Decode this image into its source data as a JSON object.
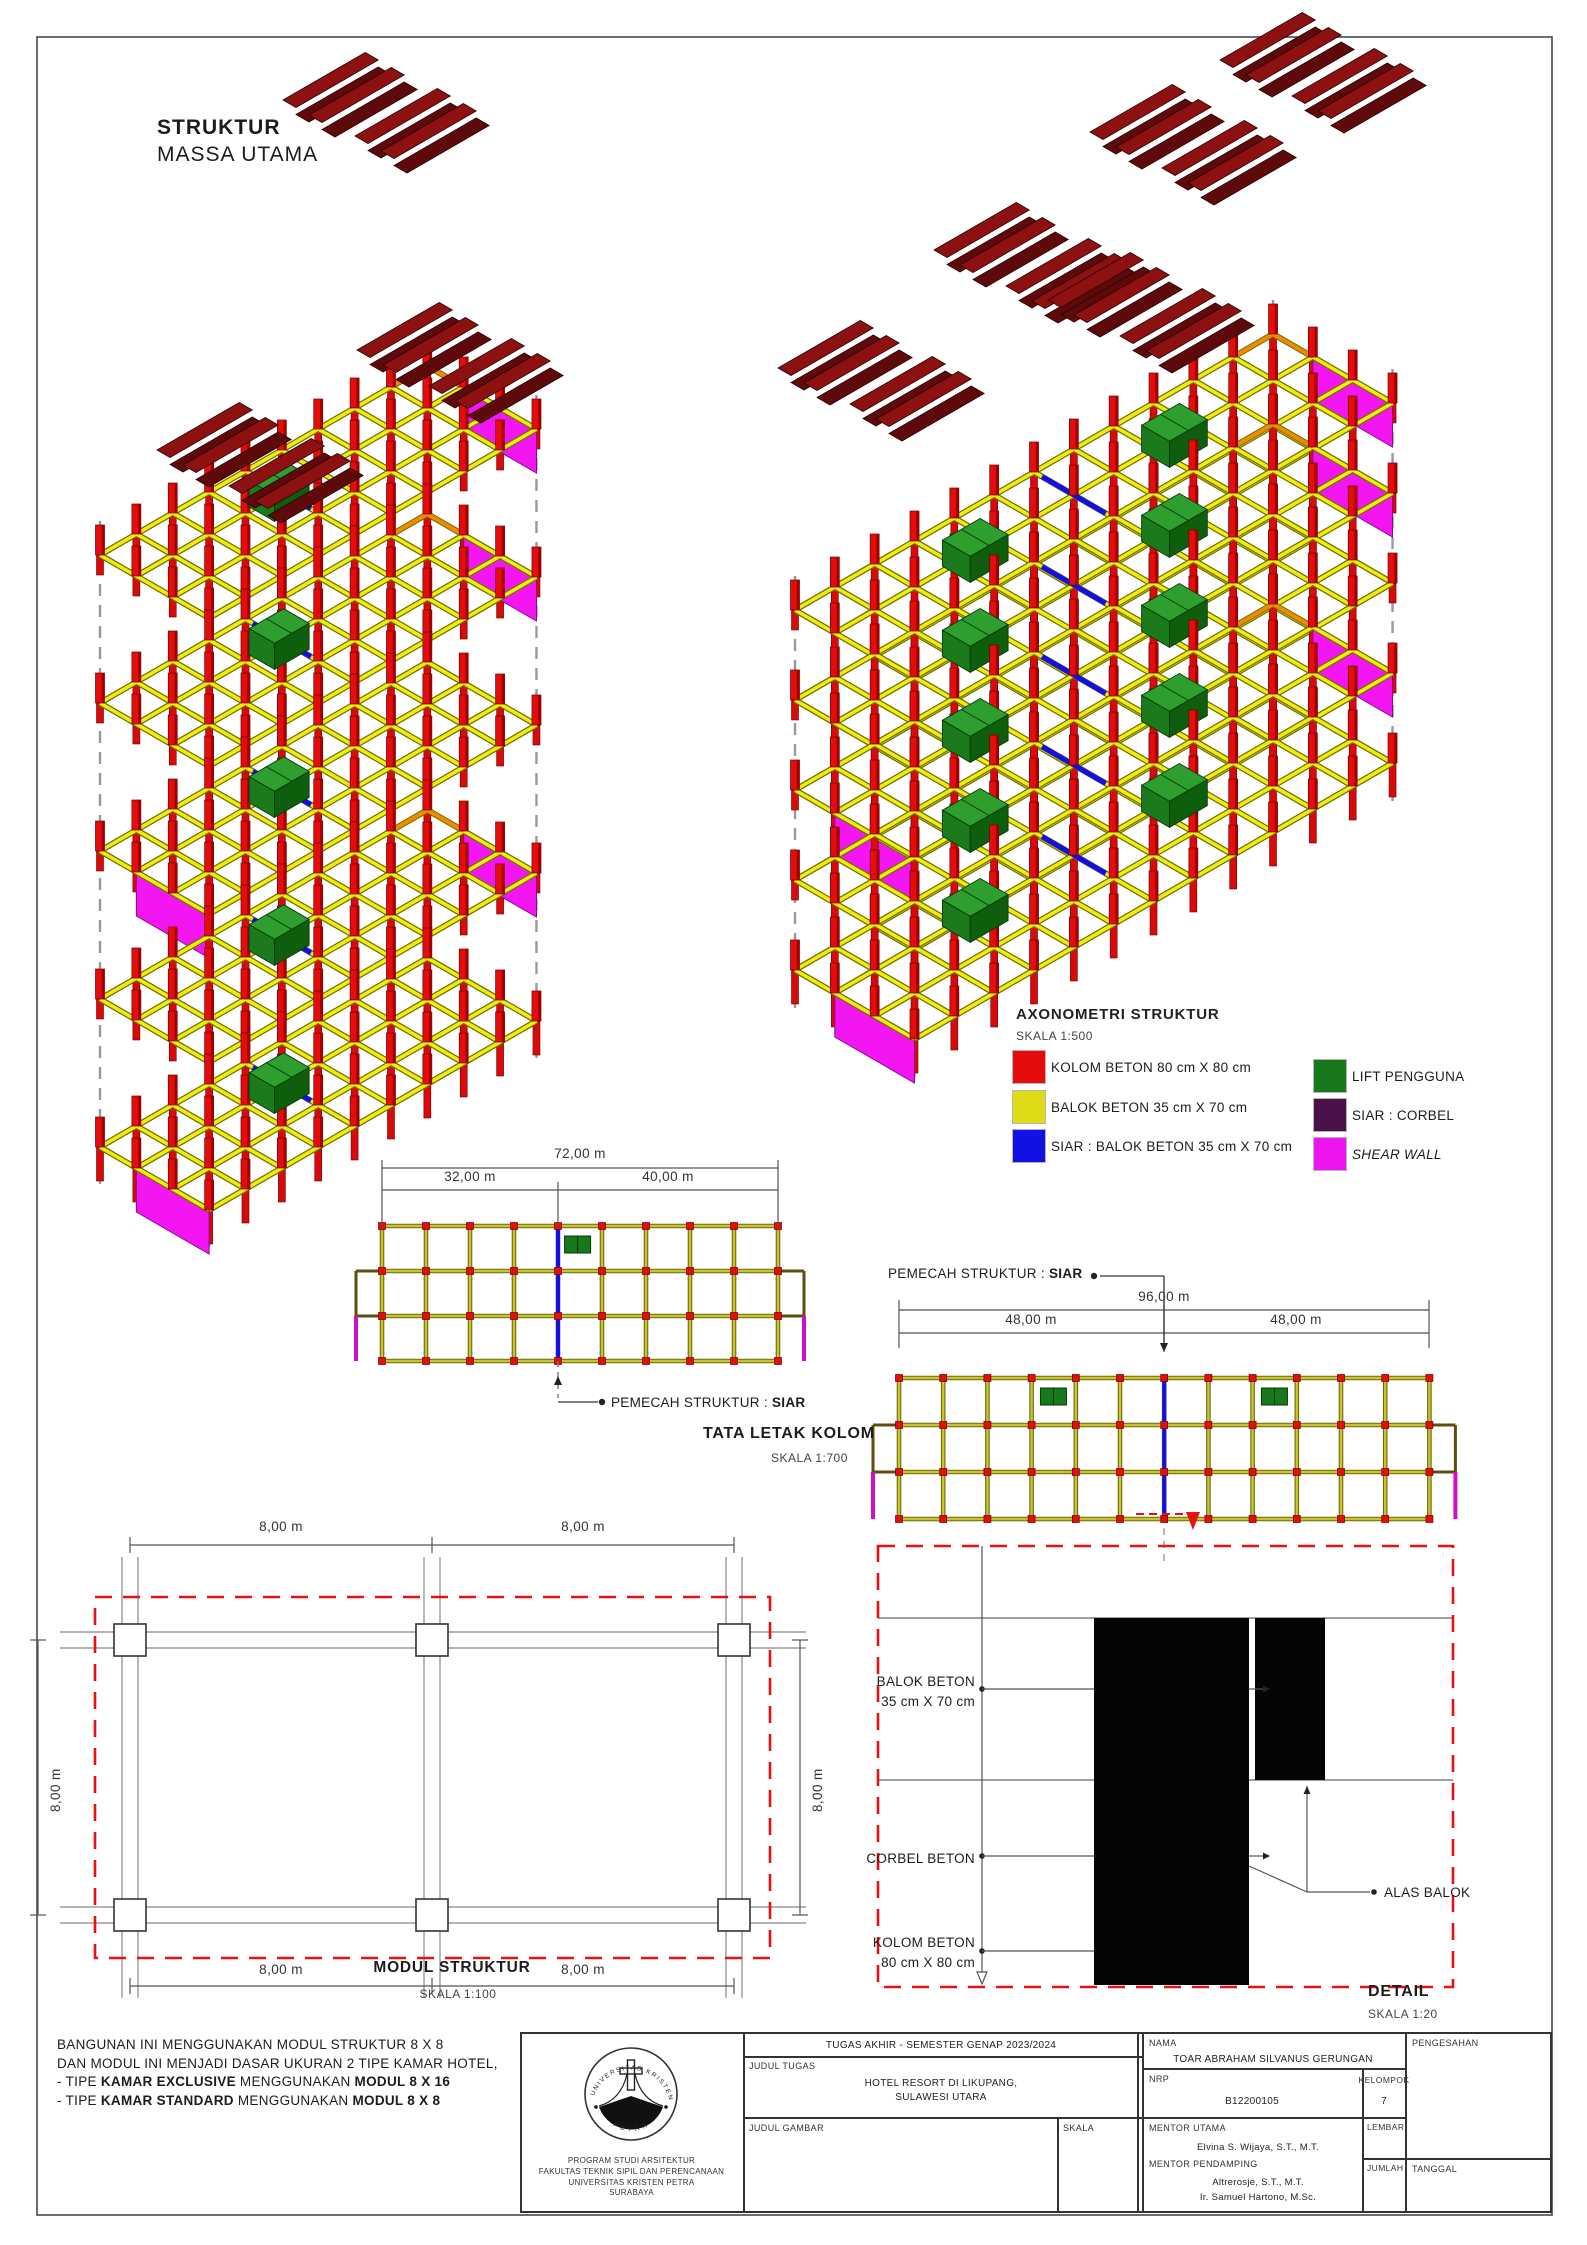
{
  "page": {
    "title_line1": "STRUKTUR",
    "title_line2": "MASSA UTAMA"
  },
  "legend": {
    "title": "AXONOMETRI STRUKTUR",
    "scale": "SKALA 1:500",
    "items": [
      {
        "name": "kolom-beton",
        "label": "KOLOM BETON 80 cm X 80 cm",
        "color": "#E50D0B"
      },
      {
        "name": "balok-beton",
        "label": "BALOK BETON 35 cm X 70 cm",
        "color": "#DFDC15"
      },
      {
        "name": "siar-balok-beton",
        "label": "SIAR : BALOK BETON 35 cm X 70 cm",
        "color": "#1310E3"
      },
      {
        "name": "lift-pengguna",
        "label": "LIFT PENGGUNA",
        "color": "#17791C"
      },
      {
        "name": "siar-corbel",
        "label": "SIAR : CORBEL",
        "color": "#491049"
      },
      {
        "name": "shear-wall",
        "label": "SHEAR WALL",
        "color": "#EE14EE",
        "italic": true
      }
    ]
  },
  "plan1": {
    "title": "TATA LETAK KOLOM",
    "scale": "SKALA 1:700",
    "dim_total": "72,00 m",
    "dim_left": "32,00 m",
    "dim_right": "40,00 m",
    "pemecah": [
      {
        "t": "PEMECAH STRUKTUR : "
      },
      {
        "t": "SIAR",
        "b": true
      }
    ]
  },
  "plan2": {
    "dim_total": "96,00 m",
    "dim_left": "48,00 m",
    "dim_right": "48,00 m",
    "pemecah": [
      {
        "t": "PEMECAH STRUKTUR : "
      },
      {
        "t": "SIAR",
        "b": true
      }
    ]
  },
  "modul": {
    "title": "MODUL STRUKTUR",
    "scale": "SKALA 1:100",
    "dim": "8,00 m"
  },
  "detail": {
    "title": "DETAIL",
    "scale": "SKALA 1:20",
    "balok_line1": "BALOK BETON",
    "balok_line2": "35 cm X 70 cm",
    "corbel": "CORBEL BETON",
    "kolom_line1": "KOLOM BETON",
    "kolom_line2": "80 cm X 80 cm",
    "alas": "ALAS BALOK"
  },
  "notes": {
    "lines": [
      [
        {
          "t": "BANGUNAN INI MENGGUNAKAN MODUL STRUKTUR 8 X 8"
        }
      ],
      [
        {
          "t": "DAN MODUL INI MENJADI DASAR UKURAN 2 TIPE KAMAR HOTEL,"
        }
      ],
      [
        {
          "t": "- TIPE "
        },
        {
          "t": "KAMAR EXCLUSIVE",
          "b": true
        },
        {
          "t": " MENGGUNAKAN "
        },
        {
          "t": "MODUL 8 X 16",
          "b": true
        }
      ],
      [
        {
          "t": "- TIPE "
        },
        {
          "t": "KAMAR STANDARD",
          "b": true
        },
        {
          "t": " MENGGUNAKAN "
        },
        {
          "t": "MODUL 8 X 8",
          "b": true
        }
      ]
    ]
  },
  "titleblock": {
    "header": "TUGAS AKHIR - SEMESTER GENAP 2023/2024",
    "judul_tugas_label": "JUDUL TUGAS",
    "judul_tugas_line1": "HOTEL RESORT DI LIKUPANG,",
    "judul_tugas_line2": "SULAWESI UTARA",
    "judul_gambar_label": "JUDUL GAMBAR",
    "skala_label": "SKALA",
    "nama_label": "NAMA",
    "nama_value": "TOAR ABRAHAM SILVANUS GERUNGAN",
    "nrp_label": "NRP",
    "nrp_value": "B12200105",
    "kelompok_label": "KELOMPOK",
    "kelompok_value": "7",
    "mentor_utama_label": "MENTOR UTAMA",
    "mentor_utama_value": "Elvina S. Wijaya, S.T., M.T.",
    "mentor_pendamping_label": "MENTOR PENDAMPING",
    "mentor_pendamping_value1": "Altrerosje, S.T., M.T.",
    "mentor_pendamping_value2": "Ir. Samuel Hartono, M.Sc.",
    "pengesahan_label": "PENGESAHAN",
    "lembar_label": "LEMBAR",
    "jumlah_label": "JUMLAH",
    "tanggal_label": "TANGGAL",
    "logo_arc_text": "UNIVERSITAS KRISTEN",
    "logo_bottom_text": "PETRA",
    "inst_line1": "PROGRAM STUDI ARSITEKTUR",
    "inst_line2": "FAKULTAS TEKNIK SIPIL DAN PERENCANAAN",
    "inst_line3": "UNIVERSITAS KRISTEN PETRA",
    "inst_line4": "SURABAYA"
  },
  "drawing": {
    "colors": {
      "col": "#E50D0B",
      "colDark": "#9E0202",
      "colEdge": "#6A0000",
      "beam": "#F0EC11",
      "beamEdge": "#6E6E00",
      "blue": "#1310E3",
      "orange": "#F08A00",
      "magenta": "#F316F3",
      "magentaEdge": "#8A088A",
      "liftTop": "#2E9E2E",
      "liftFront": "#1B7A1B",
      "liftSide": "#0E5E0E",
      "liftEdge": "#063B06",
      "roofA": "#8E1111",
      "roofB": "#5E0A0A",
      "roofEdge": "#2A0404",
      "dash": "#9a9a9a",
      "planBeam": "#C8C42A",
      "planBeamEdge": "#6E6A12",
      "ext": "#5E4E0E",
      "dimc": "#555555",
      "red": "#E81010",
      "gray": "#666666",
      "black": "#222222"
    },
    "axono": [
      {
        "origin": [
          100,
          555
        ],
        "cols": 9,
        "rows": 3,
        "cell": 42,
        "floors": 5,
        "step": 148,
        "siar": 4,
        "lifts": [
          3.2
        ],
        "panelRight": [
          0,
          1,
          3
        ],
        "panelLeft": [
          2,
          4
        ],
        "dashedNodes": [
          [
            0,
            0
          ],
          [
            0,
            3
          ],
          [
            9,
            0
          ],
          [
            9,
            3
          ],
          [
            4,
            1
          ],
          [
            5,
            2
          ]
        ],
        "roofs": [
          [
            283,
            100
          ],
          [
            355,
            136
          ],
          [
            357,
            350
          ],
          [
            429,
            386
          ],
          [
            157,
            450
          ],
          [
            229,
            486
          ]
        ]
      },
      {
        "origin": [
          795,
          610
        ],
        "cols": 12,
        "rows": 3,
        "cell": 46,
        "floors": 5,
        "step": 90,
        "siar": 6,
        "lifts": [
          2.8,
          7.8
        ],
        "panelRight": [
          0,
          1,
          3
        ],
        "panelLeft": [
          2,
          4
        ],
        "dashedNodes": [
          [
            0,
            0
          ],
          [
            0,
            3
          ],
          [
            12,
            0
          ],
          [
            12,
            3
          ],
          [
            6,
            1
          ],
          [
            3,
            2
          ],
          [
            9,
            1
          ]
        ],
        "roofs": [
          [
            778,
            368
          ],
          [
            850,
            404
          ],
          [
            934,
            250
          ],
          [
            1006,
            286
          ],
          [
            1048,
            300
          ],
          [
            1120,
            336
          ],
          [
            1090,
            132
          ],
          [
            1162,
            168
          ],
          [
            1220,
            60
          ],
          [
            1292,
            96
          ]
        ]
      }
    ],
    "plans": [
      {
        "x": 382,
        "y": 1226,
        "bays": 9,
        "bw": 44,
        "rows": 3,
        "rh": 45,
        "siar": 4,
        "lifts": [
          4.15
        ],
        "dim1": [
          382,
          1168,
          778
        ],
        "dim2": [
          382,
          1190,
          778
        ],
        "verts": [
          [
            382,
            1160,
            1226
          ],
          [
            778,
            1160,
            1226
          ],
          [
            558,
            1182,
            1226
          ]
        ],
        "leader": {
          "type": "down",
          "dash": [
            558,
            1361,
            558,
            1398
          ],
          "arrowUp": [
            558,
            1376
          ],
          "h": [
            558,
            1402,
            598
          ],
          "dot": [
            602,
            1402
          ]
        }
      },
      {
        "x": 899,
        "y": 1378,
        "bays": 12,
        "bw": 44.2,
        "rows": 3,
        "rh": 47,
        "siar": 6,
        "lifts": [
          3.2,
          8.2
        ],
        "dim1": [
          899,
          1310,
          1429
        ],
        "dim2": [
          899,
          1333,
          1429
        ],
        "verts": [
          [
            899,
            1300,
            1348
          ],
          [
            1429,
            1300,
            1348
          ],
          [
            1164,
            1300,
            1352
          ]
        ],
        "leader": {
          "type": "up",
          "dot": [
            1094,
            1276
          ],
          "h": [
            1100,
            1276,
            1164
          ],
          "v": [
            1164,
            1276,
            1350
          ],
          "arrowDown": [
            1164,
            1352
          ]
        },
        "cut": {
          "dash": [
            1136,
            1514,
            1183
          ],
          "tri": [
            [
              1186,
              1512
            ],
            [
              1200,
              1512
            ],
            [
              1193,
              1530
            ]
          ]
        },
        "tailDash": [
          1164,
          1528,
          1164,
          1566
        ]
      }
    ],
    "modul": {
      "box": [
        95,
        1597,
        675,
        361
      ],
      "colX": [
        130,
        432,
        734
      ],
      "rowY": [
        1640,
        1915
      ],
      "sq": 32,
      "pair": 16,
      "gridV": [
        1557,
        1998
      ],
      "gridH": [
        60,
        806
      ],
      "dimTop": 1545,
      "dimBot": 1986,
      "dimL": 38,
      "dimR": 800
    },
    "detail": {
      "box": [
        878,
        1546,
        575,
        441
      ],
      "lineTopY": 1618,
      "lineBeamY": 1780,
      "colRect": [
        1094,
        1618,
        155,
        367
      ],
      "beamRect": [
        1255,
        1618,
        70,
        162
      ],
      "leaderX": 982,
      "leaderY1": 1546,
      "leaderY2": 1972,
      "rowYs": [
        1689,
        1856,
        1951
      ],
      "alas": {
        "dot": [
          1374,
          1892
        ],
        "hTo": [
          1307,
          1892
        ],
        "up": [
          1307,
          1786
        ],
        "diagFrom": [
          1249,
          1866
        ]
      }
    },
    "border": [
      37,
      37,
      1515,
      2178
    ]
  }
}
